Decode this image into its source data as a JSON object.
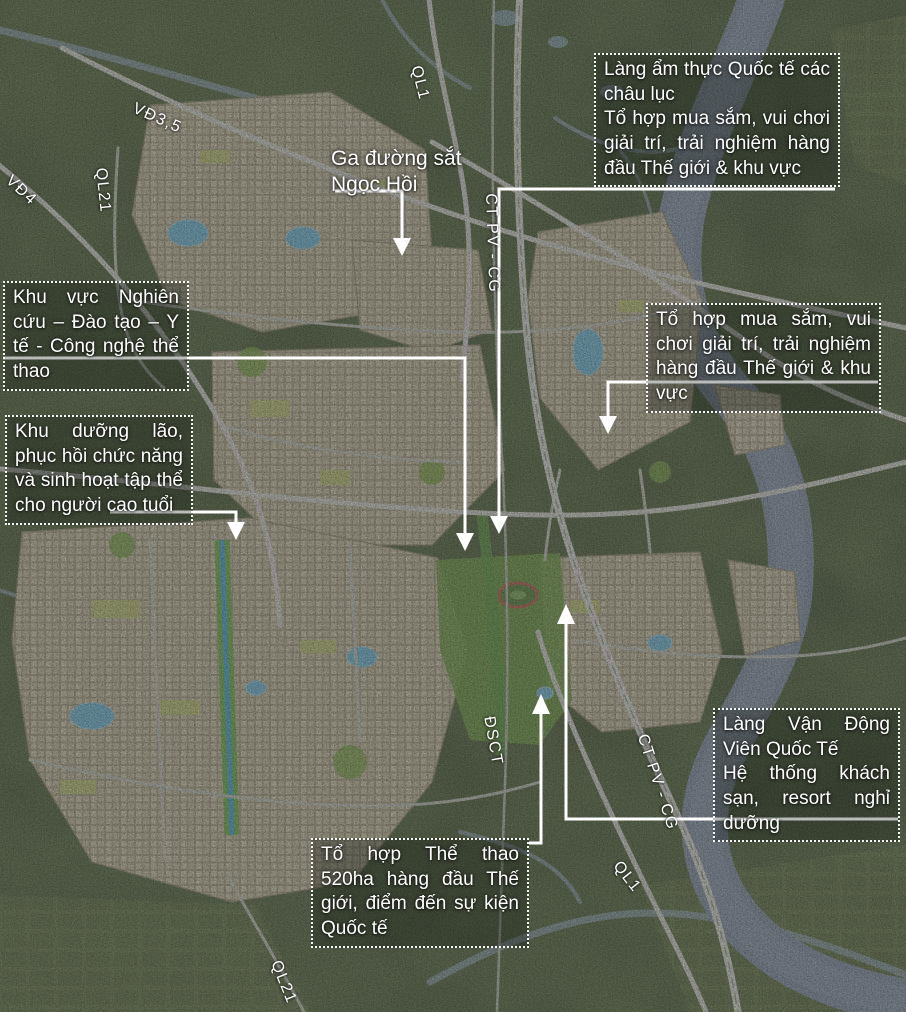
{
  "boxes": {
    "lang_am_thuc": {
      "p1": "Làng ẩm thực Quốc tế các châu lục",
      "p2": "Tổ hợp mua sắm, vui chơi giải trí, trải nghiệm hàng đầu Thế giới & khu vực"
    },
    "nghien_cuu": {
      "p1": "Khu vực Nghiên cứu – Đào tạo – Y tế - Công nghệ thể thao"
    },
    "duong_lao": {
      "p1": "Khu dưỡng lão, phục hồi chức năng và sinh hoạt tập thể cho người cao tuổi"
    },
    "mua_sam": {
      "p1": "Tổ hợp mua sắm, vui chơi giải trí, trải nghiệm hàng đầu Thế giới & khu vực"
    },
    "van_dong_vien": {
      "p1": "Làng Vận Động Viên Quốc Tế",
      "p2": "Hệ thống khách sạn, resort nghỉ dưỡng"
    },
    "the_thao": {
      "p1": "Tổ hợp Thể thao 520ha hàng đầu Thế giới, điểm đến sự kiện Quốc tế"
    },
    "ga_ngoc_hoi": {
      "p1": "Ga đường sắt Ngọc Hồi"
    }
  },
  "road_labels": [
    "QL1",
    "VĐ3,5",
    "VĐ4",
    "QL21",
    "CT PV - CG",
    "ĐSCT",
    "CT PV - CG",
    "QL1",
    "QL21"
  ],
  "colors": {
    "annotation_text": "#ffffff",
    "annotation_border": "#ffffff",
    "river": "#8493aa",
    "lake": "#72bede",
    "urban_blocks": "#d2c9ae",
    "vegetation": "#3e4b2e",
    "park_green": "#7ca747",
    "road": "#d6d8d2"
  }
}
